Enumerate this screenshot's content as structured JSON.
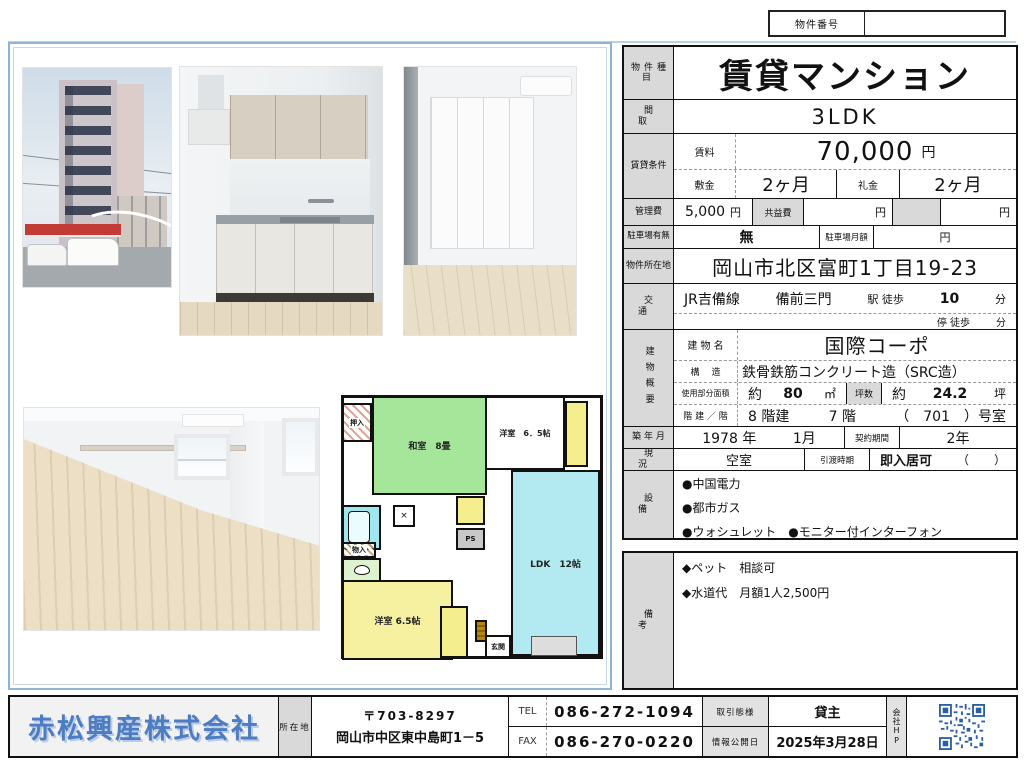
{
  "colors": {
    "accent_blue": "#4d7cc0",
    "label_bg": "#d9d9d9",
    "panel_border": "#8fb3d1",
    "washitsu_green": "#a5e69a",
    "ldk_cyan": "#b3eaf2",
    "room_yellow": "#f6f1a0",
    "bath_cyan": "#9fe6ee",
    "qr_blue": "#2b5fa5"
  },
  "property_number": {
    "label": "物件番号",
    "value": ""
  },
  "table": {
    "property_type_label": "物件種目",
    "property_type": "賃貸マンション",
    "layout_label": "間取",
    "layout": "3LDK",
    "rental_label": "賃貸条件",
    "rent_label": "賃料",
    "rent_value": "70,000",
    "yen": "円",
    "deposit_label": "敷金",
    "deposit": "2ヶ月",
    "key_money_label": "礼金",
    "key_money": "2ヶ月",
    "mgmt_label": "管理費",
    "mgmt_value": "5,000",
    "common_fee_label": "共益費",
    "parking_label": "駐車場有無",
    "parking": "無",
    "parking_monthly_label": "駐車場月額",
    "address_label": "物件所在地",
    "address": "岡山市北区富町1丁目19-23",
    "transport_label": "交通",
    "line": "JR吉備線",
    "station": "備前三門",
    "station_walk": "駅 徒歩",
    "station_min": "10",
    "min_unit": "分",
    "stop_walk": "停 徒歩",
    "building_label": "建物概要",
    "building_name_label": "建 物 名",
    "building_name": "国際コーポ",
    "structure_label": "構造",
    "structure": "鉄骨鉄筋コンクリート造（SRC造）",
    "area_label": "使用部分面積",
    "area_approx": "約",
    "area_value": "80",
    "area_unit": "㎡",
    "tsubo_label": "坪数",
    "tsubo_approx": "約",
    "tsubo_value": "24.2",
    "tsubo_unit": "坪",
    "floors_label": "階 建 ／ 階",
    "floors_value": "8 階建",
    "floor_value": "7 階",
    "room_number": "（　701　）号室",
    "built_label": "築 年 月",
    "built_year": "1978 年",
    "built_month": "1月",
    "contract_label": "契約期間",
    "contract": "2年",
    "status_label": "現況",
    "status": "空室",
    "handover_label": "引渡時期",
    "handover": "即入居可",
    "handover_paren_open": "（",
    "handover_paren_close": "）",
    "equipment_label": "設備",
    "equipment_lines": [
      "●中国電力",
      "●都市ガス",
      "●ウォシュレット　●モニター付インターフォン"
    ]
  },
  "remarks": {
    "label": "備考",
    "lines": [
      "◆ペット　相談可",
      "◆水道代　月額1人2,500円"
    ]
  },
  "floor_plan": {
    "oshiire": "押入",
    "washitsu": "和室　8畳",
    "yoshitsu_top": "洋室　6．5帖",
    "ldk": "LDK　12帖",
    "monoire": "物入",
    "ps": "PS",
    "yoshitsu_bottom": "洋室 6.5帖",
    "genkan": "玄関"
  },
  "footer": {
    "company": "赤松興産株式会社",
    "address_label": "所在地",
    "postal": "〒703-8297",
    "address": "岡山市中区東中島町1－5",
    "tel_label": "TEL",
    "tel": "086-272-1094",
    "fax_label": "FAX",
    "fax": "086-270-0220",
    "deal_label": "取引態様",
    "deal": "貸主",
    "publish_label": "情報公開日",
    "publish_date": "2025年3月28日",
    "hp_label": "会社HP"
  }
}
